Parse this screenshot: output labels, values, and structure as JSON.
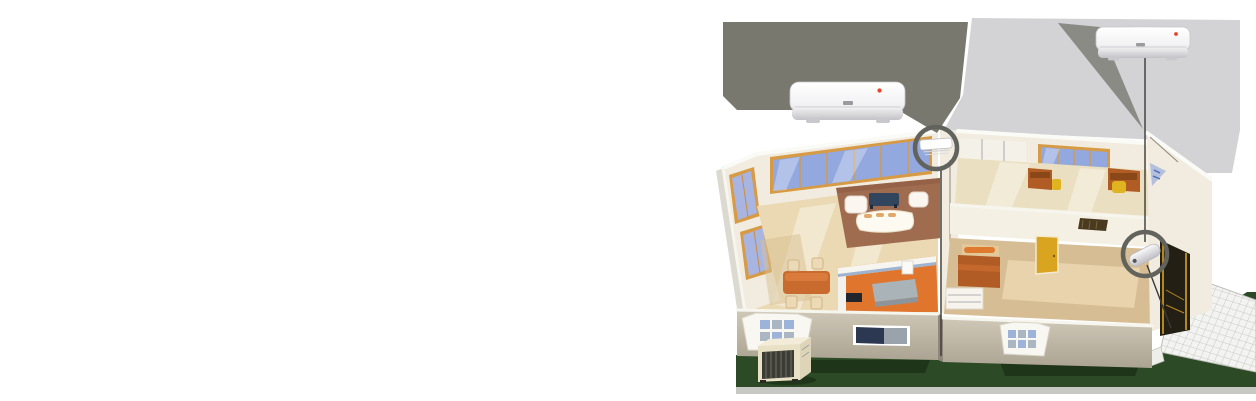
{
  "scene": {
    "width": 1256,
    "height": 401,
    "background": "#ffffff",
    "subject": "split-air-conditioner-installation-cutaway-house"
  },
  "palette": {
    "callout_dark": "#78786f",
    "callout_wedge": "#8b8b85",
    "backdrop_light": "#d3d3d5",
    "ring_gray": "#63635e",
    "connector_line": "#3a3a36",
    "ground_green": "#2c4a26",
    "ground_edge": "#c7c7c4",
    "exterior_wall": "#c6beae",
    "exterior_wall_shade": "#b1a998",
    "wall_top_white": "#fafaf6",
    "interior_cream": "#f1ecdf",
    "floor_wood": "#ead9b2",
    "floor_tan": "#d6bd94",
    "office_floor": "#eadfc0",
    "rug_brown": "#a06c50",
    "rug_light": "#e8d3ac",
    "kitchen_orange": "#e0752e",
    "window_blue": "#93a8de",
    "window_frame_orange": "#d79a45",
    "furniture_wood": "#b05c24",
    "dining_wood": "#c96a2e",
    "door_yellow": "#d9a41f",
    "coffee_table_navy": "#31455e",
    "sofa_white": "#fdfaf1",
    "unit_white": "#fdfdfd",
    "indicator_red": "#e8452a",
    "outdoor_unit_beige": "#e9e1c6",
    "grille_dark": "#3c3c35",
    "patio_tile": "#f3f3f1",
    "doorway_dark": "#241f15",
    "decal_blue": "#7f9bd8",
    "island_gray": "#aab3b8",
    "chair_yellow": "#e0b421"
  },
  "products": {
    "left_indoor_unit": "wall-mounted-indoor-unit",
    "right_indoor_unit": "wall-mounted-indoor-unit",
    "outdoor_unit": "outdoor-condenser-unit"
  },
  "rooms": {
    "living_room": "living-dining-kitchen",
    "office": "study-room",
    "bedroom": "bedroom",
    "patio": "tiled-patio"
  }
}
